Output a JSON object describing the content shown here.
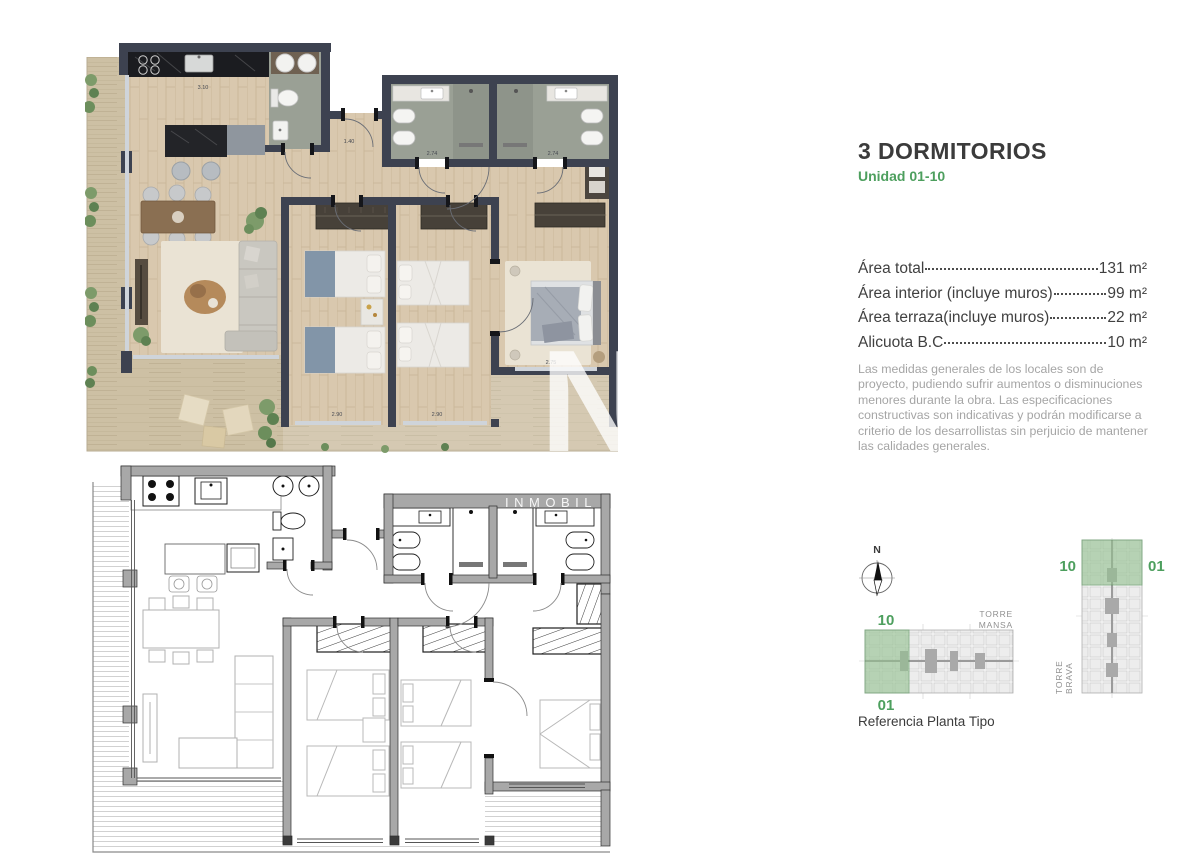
{
  "header": {
    "title": "3 DORMITORIOS",
    "subtitle": "Unidad 01-10"
  },
  "areas": {
    "rows": [
      {
        "label": "Área total",
        "value": "131 m²"
      },
      {
        "label": "Área interior (incluye muros)",
        "value": "99 m²"
      },
      {
        "label": "Área terraza(incluye muros)",
        "value": "22 m²"
      },
      {
        "label": "Alicuota B.C",
        "value": "10 m²"
      }
    ]
  },
  "disclaimer": "Las medidas generales de los locales son de proyecto, pudiendo sufrir aumentos o disminuciones menores durante la obra. Las especificaciones constructivas son indicativas y podrán modificarse a criterio de los desarrollistas sin perjuicio de mantener las calidades generales.",
  "reference": {
    "caption": "Referencia Planta Tipo",
    "compass": "N",
    "tower_mansa": {
      "name_line1": "TORRE",
      "name_line2": "MANSA",
      "label_top": "10",
      "label_bottom": "01"
    },
    "tower_brava": {
      "name_line1": "TORRE",
      "name_line2": "BRAVA",
      "label_left": "10",
      "label_right": "01"
    }
  },
  "watermarks": {
    "logo_letter": "N",
    "brand": "INMOBIL"
  },
  "dimensions": {
    "kitchen": "3.10",
    "hall": "1.40",
    "bath_left": "2.74",
    "bath_right": "2.74",
    "bedroom1": "2.90",
    "bedroom2": "2.90",
    "master": "2.75"
  },
  "colors": {
    "accent_green": "#4d9f5e",
    "highlight_green": "#93c18f",
    "wall_dark": "#3d4250",
    "wood": "#d9c8ae",
    "terrace_wood": "#cbbd9f",
    "bath_floor": "#9aa095",
    "technical_wall": "#a8a8a8",
    "text_muted": "#a5a5a5"
  }
}
